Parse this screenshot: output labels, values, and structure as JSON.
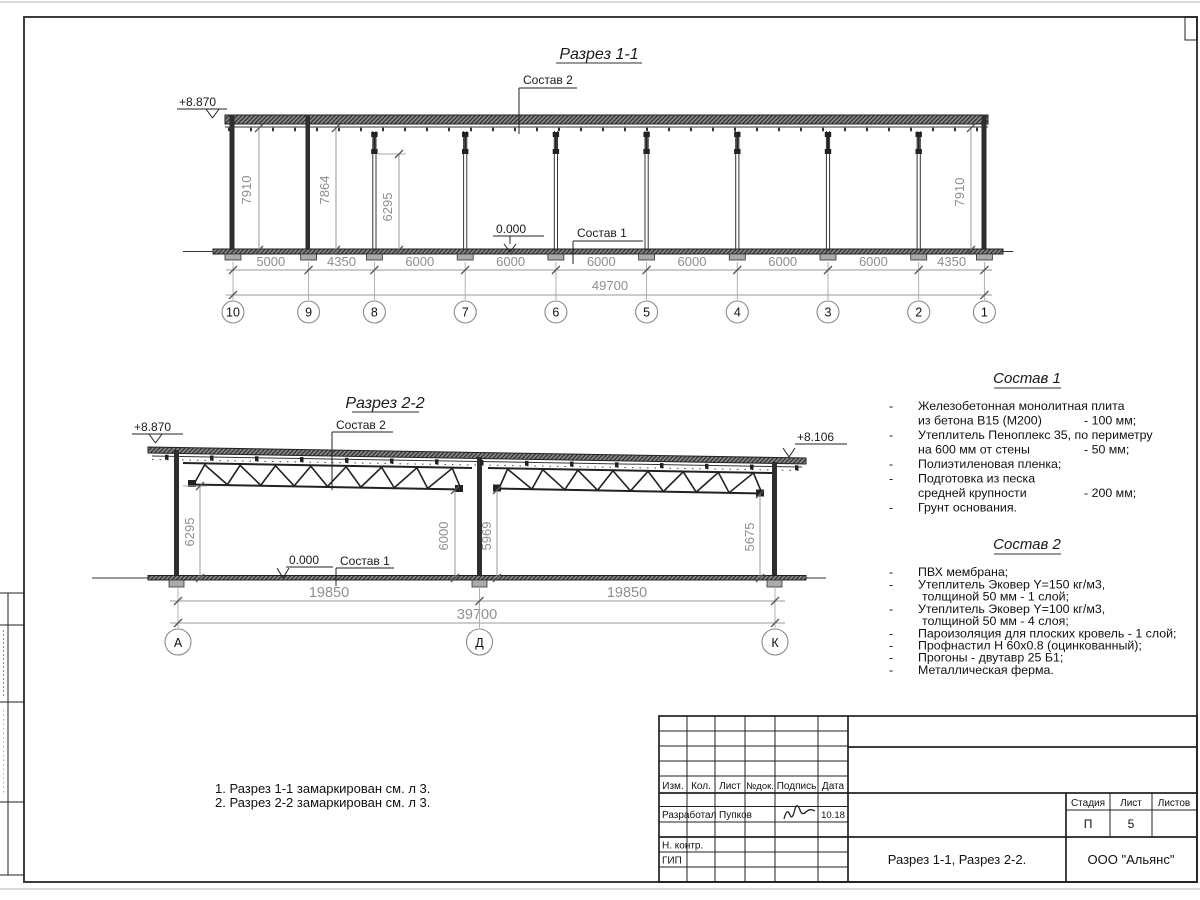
{
  "s1": {
    "title": "Разрез 1-1",
    "elev_left": "+8.870",
    "zero": "0.000",
    "c1": "Состав 1",
    "c2": "Состав 2",
    "vdims": [
      "7910",
      "7864",
      "6295",
      "7910"
    ],
    "dims": [
      "5000",
      "4350",
      "6000",
      "6000",
      "6000",
      "6000",
      "6000",
      "6000",
      "4350"
    ],
    "total": "49700",
    "axes": [
      "10",
      "9",
      "8",
      "7",
      "6",
      "5",
      "4",
      "3",
      "2",
      "1"
    ]
  },
  "s2": {
    "title": "Разрез 2-2",
    "elev_left": "+8.870",
    "elev_right": "+8.106",
    "zero": "0.000",
    "c1": "Состав 1",
    "c2": "Состав 2",
    "vdims": [
      "6295",
      "6000",
      "5969",
      "5675"
    ],
    "dims": [
      "19850",
      "19850"
    ],
    "total": "39700",
    "axes": [
      "А",
      "Д",
      "К"
    ]
  },
  "comp1": {
    "heading": "Состав 1",
    "lines": [
      {
        "d": "-",
        "t": "Железобетонная  монолитная плита",
        "v": ""
      },
      {
        "d": "",
        "t": "из бетона В15 (М200)",
        "v": "- 100 мм;"
      },
      {
        "d": "-",
        "t": "Утеплитель Пеноплекс 35, по периметру",
        "v": ""
      },
      {
        "d": "",
        "t": "на 600 мм от стены",
        "v": "- 50 мм;"
      },
      {
        "d": "-",
        "t": "Полиэтиленовая пленка;",
        "v": ""
      },
      {
        "d": "-",
        "t": "Подготовка из песка",
        "v": ""
      },
      {
        "d": "",
        "t": "средней крупности",
        "v": "- 200 мм;"
      },
      {
        "d": "-",
        "t": "Грунт основания.",
        "v": ""
      }
    ]
  },
  "comp2": {
    "heading": "Состав 2",
    "lines": [
      {
        "d": "-",
        "t": "ПВХ мембрана;"
      },
      {
        "d": "-",
        "t": "Утеплитель Эковер Y=150 кг/м3,"
      },
      {
        "d": "",
        "t": "толщиной 50 мм - 1 слой;"
      },
      {
        "d": "-",
        "t": "Утеплитель Эковер Y=100 кг/м3,"
      },
      {
        "d": "",
        "t": "толщиной 50 мм - 4 слоя;"
      },
      {
        "d": "-",
        "t": "Пароизоляция для плоских кровель - 1 слой;"
      },
      {
        "d": "-",
        "t": "Профнастил Н 60х0.8 (оцинкованный);"
      },
      {
        "d": "-",
        "t": "Прогоны - двутавр 25 Б1;"
      },
      {
        "d": "-",
        "t": "Металлическая ферма."
      }
    ]
  },
  "notes": [
    "1. Разрез 1-1 замаркирован см. л 3.",
    "2. Разрез 2-2 замаркирован см. л 3."
  ],
  "stamp": {
    "cols": [
      "Изм.",
      "Кол.",
      "Лист",
      "№док.",
      "Подпись",
      "Дата"
    ],
    "razrabotal": "Разработал",
    "razrabotal_name": "Пупков",
    "date": "10.18",
    "nkontr": "Н. контр.",
    "gip": "ГИП",
    "stage_label": "Стадия",
    "sheet_label": "Лист",
    "sheets_label": "Листов",
    "stage": "П",
    "sheet_num": "5",
    "doc_title": "Разрез 1-1, Разрез 2-2.",
    "company": "ООО \"Альянс\""
  }
}
